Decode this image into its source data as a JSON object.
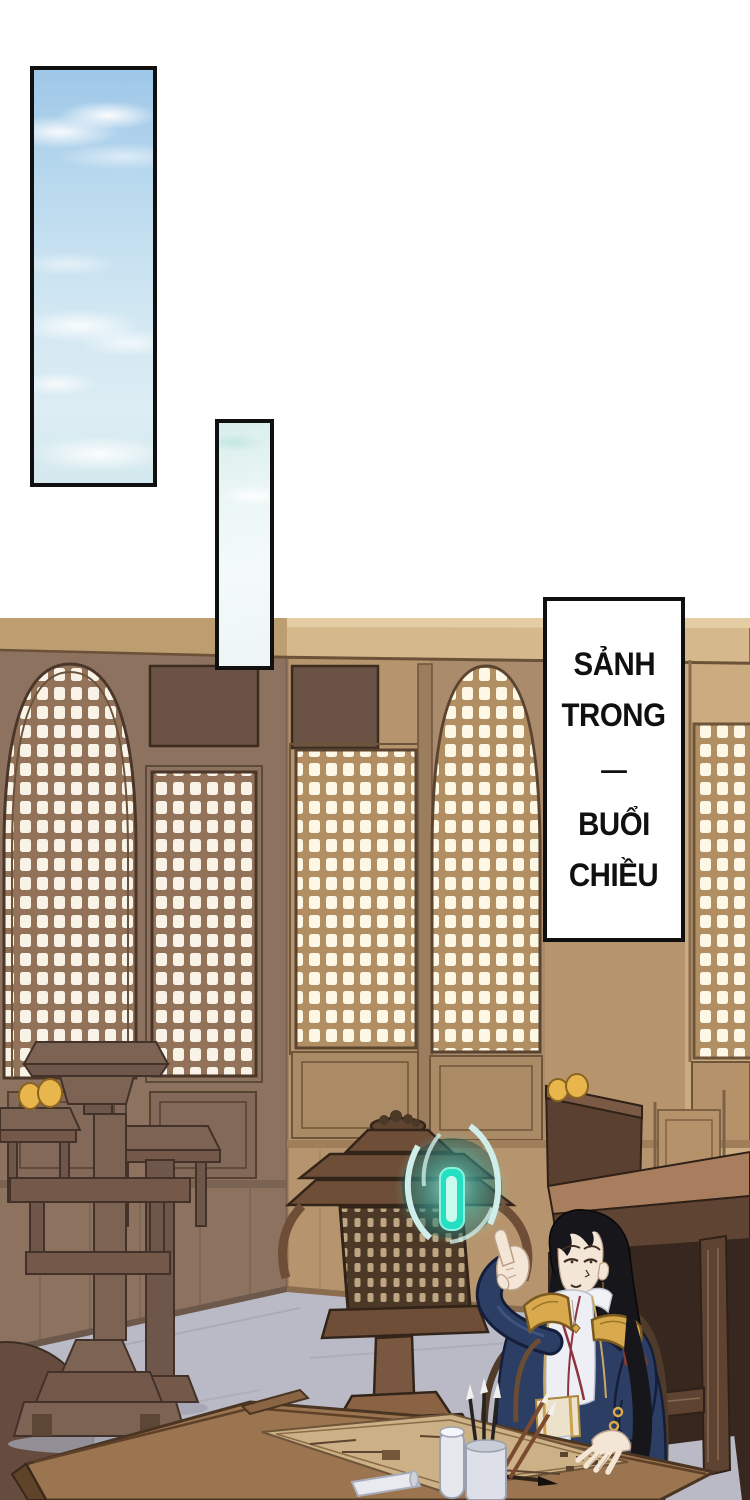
{
  "caption": {
    "lines": [
      "SẢNH",
      "TRONG",
      "—",
      "BUỔI",
      "CHIỀU"
    ]
  },
  "scene_objects": {
    "panel_top": "tall sky panel with clouds",
    "panel_small": "small pale sky panel",
    "interior": "wooden hall with lattice windows, lantern, seated mage"
  },
  "colors": {
    "page-bg": "#ffffff",
    "ink": "#101010",
    "sky-top": "#9ec7e8",
    "sky-mid": "#cfe6f2",
    "sky-low": "#dcedf3",
    "panel2-top": "#d8eeec",
    "panel2-low": "#f4fafa",
    "beam": "#d5b98c",
    "beam-left": "#bd9e71",
    "beam-light": "#e4cda2",
    "wall-left": "#8d7260",
    "wall-front": "#b6956e",
    "wall-front-light": "#cbac80",
    "wall-front-dark": "#aa8b6b",
    "transom": "#6a5245",
    "lattice-bar-left": "#93725a",
    "lattice-bar-front": "#b28e63",
    "lattice-hole": "#f8f3e6",
    "wood-dark": "#6f4e38",
    "wood-line": "#33241a",
    "furniture": "#7d6354",
    "furniture-line": "#42322a",
    "bench": "#5e4332",
    "bench-top": "#a87e5e",
    "shadow": "#37271e",
    "floor": "#b9bac5",
    "desk": "#9b7450",
    "map": "#ccb086",
    "glow-bar": "#25dfc2",
    "glow-light": "#c8fbee",
    "swirl": "#cfeeea",
    "robe": "#2c3e63",
    "robe-line": "#141e3a",
    "gold": "#d9a94e",
    "gold-dark": "#7a5a20",
    "skin": "#f4e6d6",
    "skin-line": "#bb9e87",
    "hair": "#17171b",
    "fruit": "#e9b54d",
    "white-cloth": "#edeff4",
    "red-trim": "#8e3440"
  }
}
